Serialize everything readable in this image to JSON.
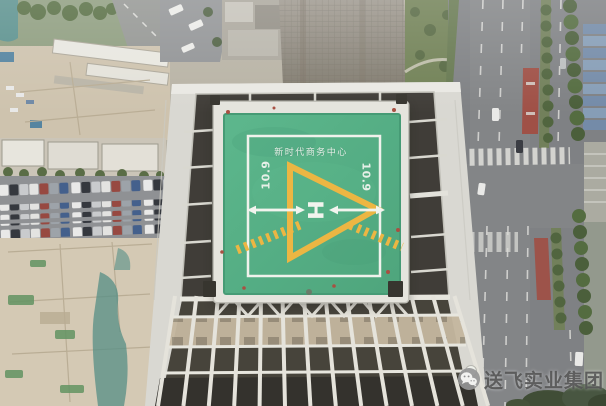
{
  "image": {
    "type": "aerial-drone-photo",
    "subject": "rooftop helipad on a high-rise building under construction, city streets below"
  },
  "helipad": {
    "title": "新时代商务中心",
    "dimension_left": "10.9",
    "dimension_right": "10.9",
    "h_marking": "H",
    "colors": {
      "pad_green": "#4fad81",
      "marking_yellow": "#ecb33c",
      "marking_white": "#f0f2ec"
    }
  },
  "watermark": {
    "icon": "wechat-icon",
    "text": "送飞实业集团",
    "text_color": "#4e4e4e"
  }
}
